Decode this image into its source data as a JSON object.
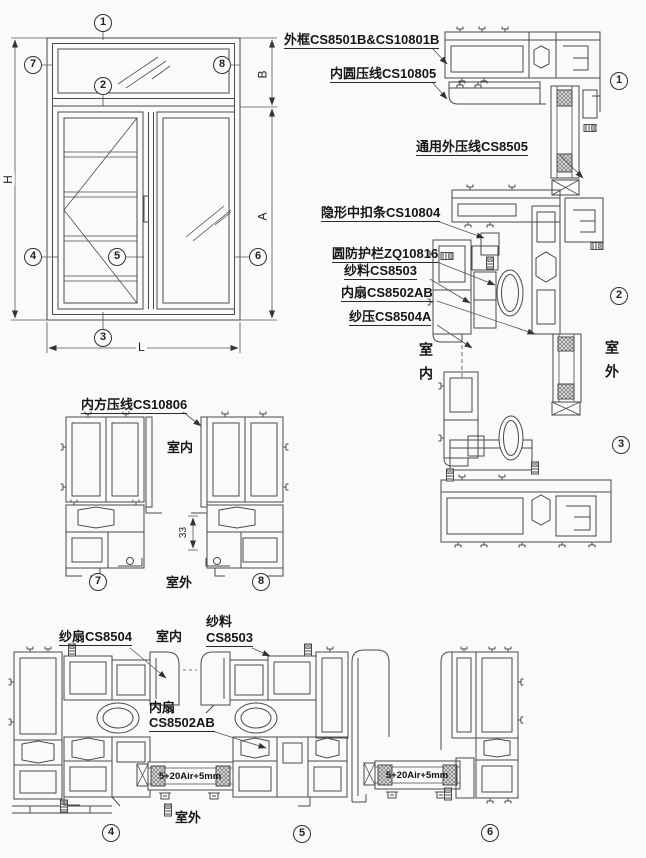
{
  "elevation": {
    "markers": [
      "1",
      "7",
      "8",
      "2",
      "4",
      "5",
      "6",
      "3"
    ],
    "dims": {
      "height": "H",
      "transom": "B",
      "sash": "A",
      "width": "L"
    }
  },
  "vertical_section": {
    "callouts": {
      "outer_frame": "外框CS8501B&CS10801B",
      "inner_round_bead": "内圆压线CS10805",
      "universal_outer_bead": "通用外压线CS8505",
      "hidden_mid_clip": "隐形中扣条CS10804",
      "round_guard_bar": "圆防护栏ZQ10816",
      "screen_material": "纱料CS8503",
      "inner_sash": "内扇CS8502AB",
      "screen_bead": "纱压CS8504A"
    },
    "indoor": "室内",
    "outdoor": "室外",
    "markers": [
      "1",
      "2",
      "3"
    ]
  },
  "corner_sections": {
    "callout_inner_square_bead": "内方压线CS10806",
    "indoor": "室内",
    "outdoor": "室外",
    "dim_offset": "33",
    "markers": [
      "7",
      "8"
    ]
  },
  "horizontal_section": {
    "callout_screen_sash": "纱扇CS8504",
    "callout_screen_material_l1": "纱料",
    "callout_screen_material_l2": "CS8503",
    "callout_inner_sash_l1": "内扇",
    "callout_inner_sash_l2": "CS8502AB",
    "indoor": "室内",
    "outdoor": "室外",
    "glass_spec": "5+20Air+5mm",
    "markers": [
      "4",
      "5",
      "6"
    ]
  },
  "colors": {
    "line": "#4a4a4a",
    "thin_line": "#5a5a5a",
    "text": "#1c1c1c",
    "paper": "#fbfaf8"
  }
}
